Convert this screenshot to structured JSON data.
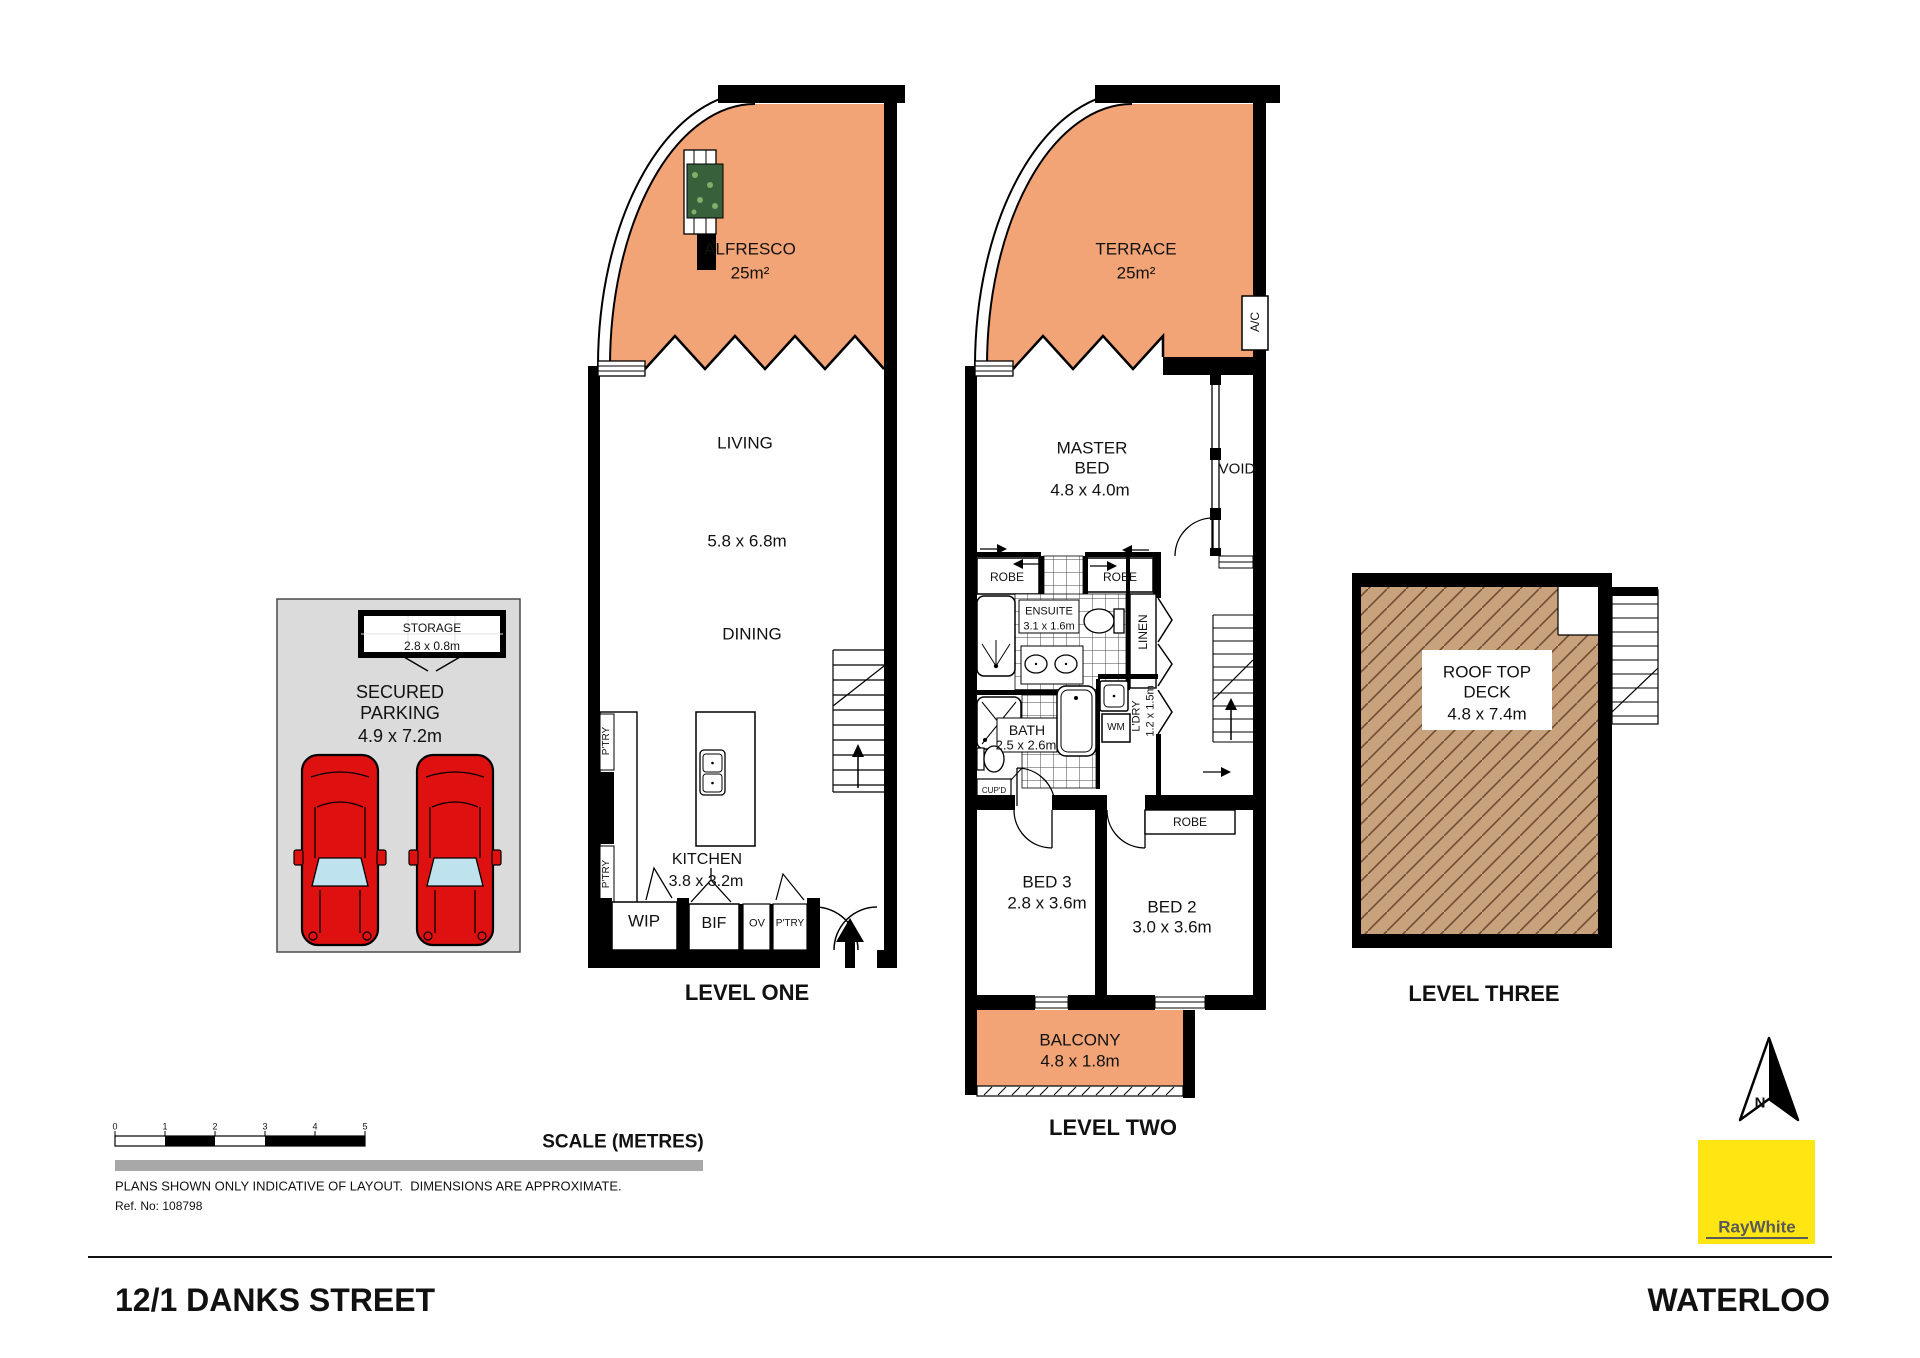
{
  "colors": {
    "outdoor": "#F2A477",
    "deck": "#C8A17D",
    "deckHatch": "#6F4F33",
    "parking": "#DBDBDB",
    "car": "#DE1010",
    "glass": "#BFE3EE",
    "brand": "#FFE512",
    "brandText": "#58595B"
  },
  "labels": [
    {
      "n": "alfresco-label",
      "t": "ALFRESCO",
      "x": 750,
      "y": 249,
      "s": 17
    },
    {
      "n": "alfresco-area",
      "t": "25m²",
      "x": 750,
      "y": 273,
      "s": 17
    },
    {
      "n": "living-label",
      "t": "LIVING",
      "x": 745,
      "y": 443,
      "s": 17
    },
    {
      "n": "living-dims",
      "t": "5.8 x 6.8m",
      "x": 747,
      "y": 541,
      "s": 17
    },
    {
      "n": "dining-label",
      "t": "DINING",
      "x": 752,
      "y": 634,
      "s": 17
    },
    {
      "n": "kitchen-label",
      "t": "KITCHEN",
      "x": 707,
      "y": 860,
      "s": 16
    },
    {
      "n": "kitchen-dims",
      "t": "3.8 x 3.2m",
      "x": 706,
      "y": 882,
      "s": 16
    },
    {
      "n": "pantry-upper-label",
      "t": "P'TRY",
      "x": 607,
      "y": 741,
      "s": 10,
      "r": 1
    },
    {
      "n": "pantry-lower-label",
      "t": "P'TRY",
      "x": 607,
      "y": 874,
      "s": 10,
      "r": 1
    },
    {
      "n": "wip-label",
      "t": "WIP",
      "x": 644,
      "y": 921,
      "s": 17
    },
    {
      "n": "bif-label",
      "t": "BIF",
      "x": 714,
      "y": 924,
      "s": 16
    },
    {
      "n": "oven-label",
      "t": "OV",
      "x": 757,
      "y": 924,
      "s": 11
    },
    {
      "n": "pantry-bottom-label",
      "t": "P'TRY",
      "x": 790,
      "y": 924,
      "s": 10
    },
    {
      "n": "level-one-title",
      "t": "LEVEL ONE",
      "x": 747,
      "y": 993,
      "s": 22,
      "b": 1
    },
    {
      "n": "storage-label",
      "t": "STORAGE",
      "x": 432,
      "y": 628,
      "s": 12
    },
    {
      "n": "storage-dims",
      "t": "2.8 x 0.8m",
      "x": 432,
      "y": 646,
      "s": 12
    },
    {
      "n": "parking-line1",
      "t": "SECURED",
      "x": 400,
      "y": 692,
      "s": 18
    },
    {
      "n": "parking-line2",
      "t": "PARKING",
      "x": 400,
      "y": 713,
      "s": 18
    },
    {
      "n": "parking-dims",
      "t": "4.9 x 7.2m",
      "x": 400,
      "y": 736,
      "s": 18
    },
    {
      "n": "terrace-label",
      "t": "TERRACE",
      "x": 1136,
      "y": 249,
      "s": 17
    },
    {
      "n": "terrace-area",
      "t": "25m²",
      "x": 1136,
      "y": 273,
      "s": 17
    },
    {
      "n": "ac-label",
      "t": "A/C",
      "x": 1255,
      "y": 322,
      "s": 12,
      "r": 1
    },
    {
      "n": "master-line1",
      "t": "MASTER",
      "x": 1092,
      "y": 448,
      "s": 17
    },
    {
      "n": "master-line2",
      "t": "BED",
      "x": 1092,
      "y": 468,
      "s": 17
    },
    {
      "n": "master-dims",
      "t": "4.8 x 4.0m",
      "x": 1090,
      "y": 490,
      "s": 17
    },
    {
      "n": "void-label",
      "t": "VOID",
      "x": 1237,
      "y": 469,
      "s": 15
    },
    {
      "n": "robe-left-label",
      "t": "ROBE",
      "x": 1007,
      "y": 577,
      "s": 12
    },
    {
      "n": "robe-right-label",
      "t": "ROBE",
      "x": 1120,
      "y": 577,
      "s": 12
    },
    {
      "n": "ensuite-label",
      "t": "ENSUITE",
      "x": 1049,
      "y": 612,
      "s": 11
    },
    {
      "n": "ensuite-dims",
      "t": "3.1 x 1.6m",
      "x": 1049,
      "y": 627,
      "s": 11
    },
    {
      "n": "linen-label",
      "t": "LINEN",
      "x": 1143,
      "y": 632,
      "s": 12,
      "r": 1
    },
    {
      "n": "bath-label",
      "t": "BATH",
      "x": 1027,
      "y": 730,
      "s": 14
    },
    {
      "n": "bath-dims",
      "t": "2.5 x 2.6m",
      "x": 1026,
      "y": 745,
      "s": 13
    },
    {
      "n": "wm-label",
      "t": "WM",
      "x": 1116,
      "y": 728,
      "s": 10
    },
    {
      "n": "laundry-label",
      "t": "L'DRY",
      "x": 1137,
      "y": 716,
      "s": 11,
      "r": 1
    },
    {
      "n": "laundry-dims",
      "t": "1.2 x 1.5m",
      "x": 1151,
      "y": 711,
      "s": 11,
      "r": 1
    },
    {
      "n": "cupboard-label",
      "t": "CUP'D",
      "x": 994,
      "y": 791,
      "s": 8
    },
    {
      "n": "robe-bed2-label",
      "t": "ROBE",
      "x": 1190,
      "y": 822,
      "s": 12
    },
    {
      "n": "bed3-label",
      "t": "BED 3",
      "x": 1047,
      "y": 882,
      "s": 17
    },
    {
      "n": "bed3-dims",
      "t": "2.8 x 3.6m",
      "x": 1047,
      "y": 903,
      "s": 17
    },
    {
      "n": "bed2-label",
      "t": "BED 2",
      "x": 1172,
      "y": 907,
      "s": 17
    },
    {
      "n": "bed2-dims",
      "t": "3.0 x 3.6m",
      "x": 1172,
      "y": 927,
      "s": 17
    },
    {
      "n": "balcony-label",
      "t": "BALCONY",
      "x": 1080,
      "y": 1040,
      "s": 17
    },
    {
      "n": "balcony-dims",
      "t": "4.8 x 1.8m",
      "x": 1080,
      "y": 1061,
      "s": 17
    },
    {
      "n": "level-two-title",
      "t": "LEVEL TWO",
      "x": 1113,
      "y": 1128,
      "s": 22,
      "b": 1
    },
    {
      "n": "rooftop-line1",
      "t": "ROOF TOP",
      "x": 1487,
      "y": 672,
      "s": 17
    },
    {
      "n": "rooftop-line2",
      "t": "DECK",
      "x": 1487,
      "y": 692,
      "s": 17
    },
    {
      "n": "rooftop-dims",
      "t": "4.8 x 7.4m",
      "x": 1487,
      "y": 714,
      "s": 17
    },
    {
      "n": "level-three-title",
      "t": "LEVEL THREE",
      "x": 1484,
      "y": 994,
      "s": 22,
      "b": 1
    },
    {
      "n": "scale-tick-0",
      "t": "0",
      "x": 115,
      "y": 1127,
      "s": 9
    },
    {
      "n": "scale-tick-1",
      "t": "1",
      "x": 165,
      "y": 1127,
      "s": 9
    },
    {
      "n": "scale-tick-2",
      "t": "2",
      "x": 215,
      "y": 1127,
      "s": 9
    },
    {
      "n": "scale-tick-3",
      "t": "3",
      "x": 265,
      "y": 1127,
      "s": 9
    },
    {
      "n": "scale-tick-4",
      "t": "4",
      "x": 315,
      "y": 1127,
      "s": 9
    },
    {
      "n": "scale-tick-5",
      "t": "5",
      "x": 365,
      "y": 1127,
      "s": 9
    },
    {
      "n": "scale-title",
      "t": "SCALE (METRES)",
      "x": 623,
      "y": 1142,
      "s": 19,
      "b": 1
    },
    {
      "n": "disclaimer-text",
      "t": "PLANS SHOWN ONLY INDICATIVE OF LAYOUT.  DIMENSIONS ARE APPROXIMATE.",
      "x": 115,
      "y": 1186,
      "s": 13,
      "a": "l"
    },
    {
      "n": "reference-number",
      "t": "Ref. No: 108798",
      "x": 115,
      "y": 1206,
      "s": 12,
      "a": "l"
    },
    {
      "n": "street-address",
      "t": "12/1 DANKS STREET",
      "x": 115,
      "y": 1300,
      "s": 32,
      "b": 1,
      "a": "l"
    },
    {
      "n": "suburb-name",
      "t": "WATERLOO",
      "x": 1830,
      "y": 1300,
      "s": 32,
      "b": 1,
      "a": "r"
    },
    {
      "n": "brand-wordmark",
      "t": "RayWhite",
      "x": 1757,
      "y": 1227,
      "s": 17,
      "b": 1,
      "c": "#58595B"
    },
    {
      "n": "north-letter",
      "t": "N",
      "x": 1760,
      "y": 1103,
      "s": 15,
      "b": 1
    }
  ]
}
